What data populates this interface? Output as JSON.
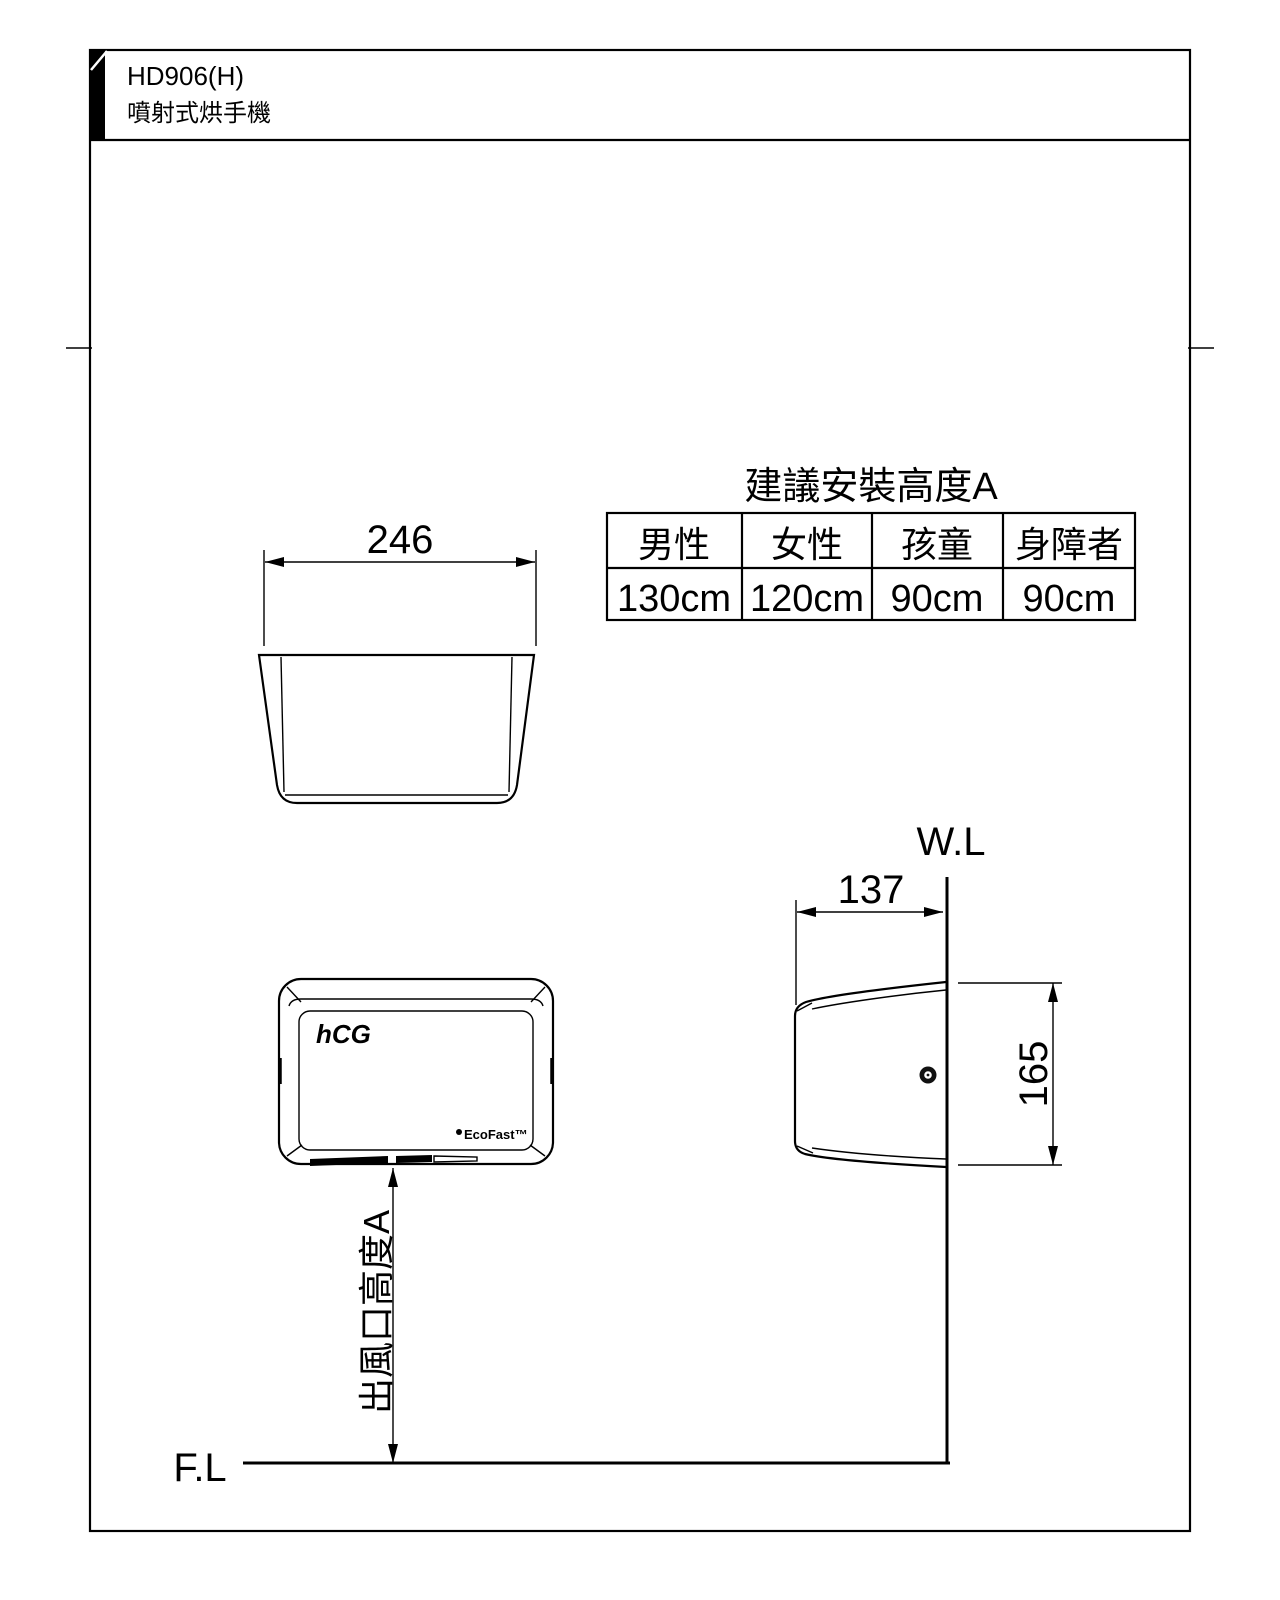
{
  "title_block": {
    "model": "HD906(H)",
    "product": "噴射式烘手機"
  },
  "install_table": {
    "title": "建議安裝高度A",
    "headers": [
      "男性",
      "女性",
      "孩童",
      "身障者"
    ],
    "values": [
      "130cm",
      "120cm",
      "90cm",
      "90cm"
    ]
  },
  "dimensions": {
    "top_width": "246",
    "depth": "137",
    "height": "165"
  },
  "labels": {
    "wall_line": "W.L",
    "floor_line": "F.L",
    "outlet_height": "出風口高度A"
  },
  "device": {
    "brand": "hCG",
    "badge": "EcoFast™"
  },
  "colors": {
    "line": "#000000",
    "background": "#ffffff"
  }
}
